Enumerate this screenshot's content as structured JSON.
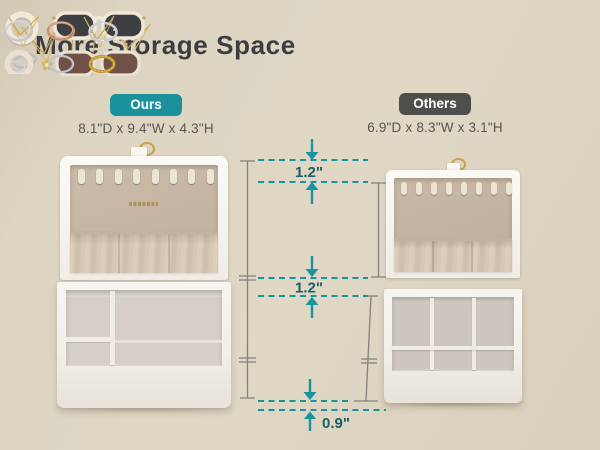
{
  "page_title": "More Storage Space",
  "ours": {
    "badge_label": "Ours",
    "dimensions": "8.1\"D x 9.4\"W x 4.3\"H"
  },
  "others": {
    "badge_label": "Others",
    "dimensions": "6.9\"D x 8.3\"W x 3.1\"H"
  },
  "measurements": {
    "top_gap": "1.2\"",
    "middle_gap": "1.2\"",
    "bottom_gap": "0.9\""
  },
  "colors": {
    "accent_teal": "#1A929E",
    "badge_gray": "#4E4E4C",
    "measurement_teal": "#17949F",
    "measurement_text": "#175F69",
    "background_beige": "#DBD2C0"
  }
}
